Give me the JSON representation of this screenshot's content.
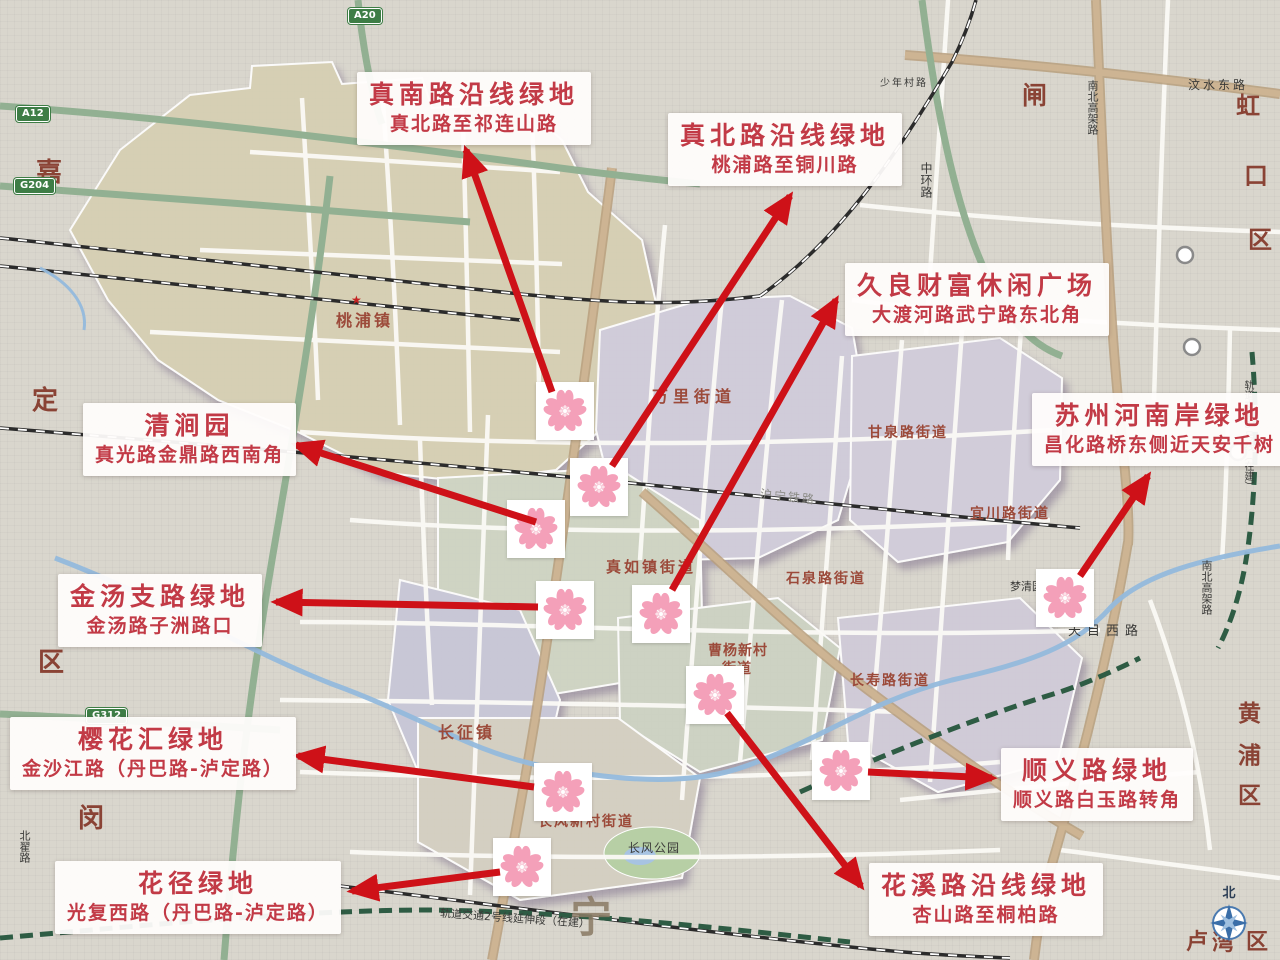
{
  "annotations": {
    "labels": [
      {
        "title": "真南路沿线绿地",
        "subtitle": "真北路至祁连山路"
      },
      {
        "title": "真北路沿线绿地",
        "subtitle": "桃浦路至铜川路"
      },
      {
        "title": "久良财富休闲广场",
        "subtitle": "大渡河路武宁路东北角"
      },
      {
        "title": "苏州河南岸绿地",
        "subtitle": "昌化路桥东侧近天安千树"
      },
      {
        "title": "清涧园",
        "subtitle": "真光路金鼎路西南角"
      },
      {
        "title": "金汤支路绿地",
        "subtitle": "金汤路子洲路口"
      },
      {
        "title": "樱花汇绿地",
        "subtitle": "金沙江路（丹巴路-泸定路）"
      },
      {
        "title": "花径绿地",
        "subtitle": "光复西路（丹巴路-泸定路）"
      },
      {
        "title": "顺义路绿地",
        "subtitle": "顺义路白玉路转角"
      },
      {
        "title": "花溪路沿线绿地",
        "subtitle": "杏山路至桐柏路"
      }
    ],
    "marker_count": 10,
    "colors": {
      "label_text": "#c23a46",
      "arrow": "#ce1118",
      "blossom_petal": "#f4a0b9"
    }
  },
  "map": {
    "district_chars": [
      "嘉",
      "定",
      "区",
      "闵",
      "闸",
      "虹",
      "口",
      "区",
      "黄",
      "浦",
      "区",
      "卢",
      "湾",
      "区",
      "宁"
    ],
    "subdistrict_labels": [
      "桃浦镇",
      "万里街道",
      "甘泉路街道",
      "宜川路街道",
      "真如镇街道",
      "石泉路街道",
      "曹杨新村",
      "街道",
      "长寿路街道",
      "长征镇",
      "长风新村街道"
    ],
    "place_labels": [
      "长风公园",
      "梦清园"
    ],
    "rail_labels": [
      "沪宁铁路",
      "轨道交通2号线延伸段（在建）",
      "轨道交通8号线（在建）"
    ],
    "road_labels": [
      "天目西路",
      "汶水东路",
      "中环路",
      "南北高架路",
      "少年村路",
      "北翟路"
    ],
    "highway_badges": [
      "A12",
      "A20",
      "G204",
      "G312"
    ],
    "star_icon": "★",
    "compass_label": "北"
  }
}
